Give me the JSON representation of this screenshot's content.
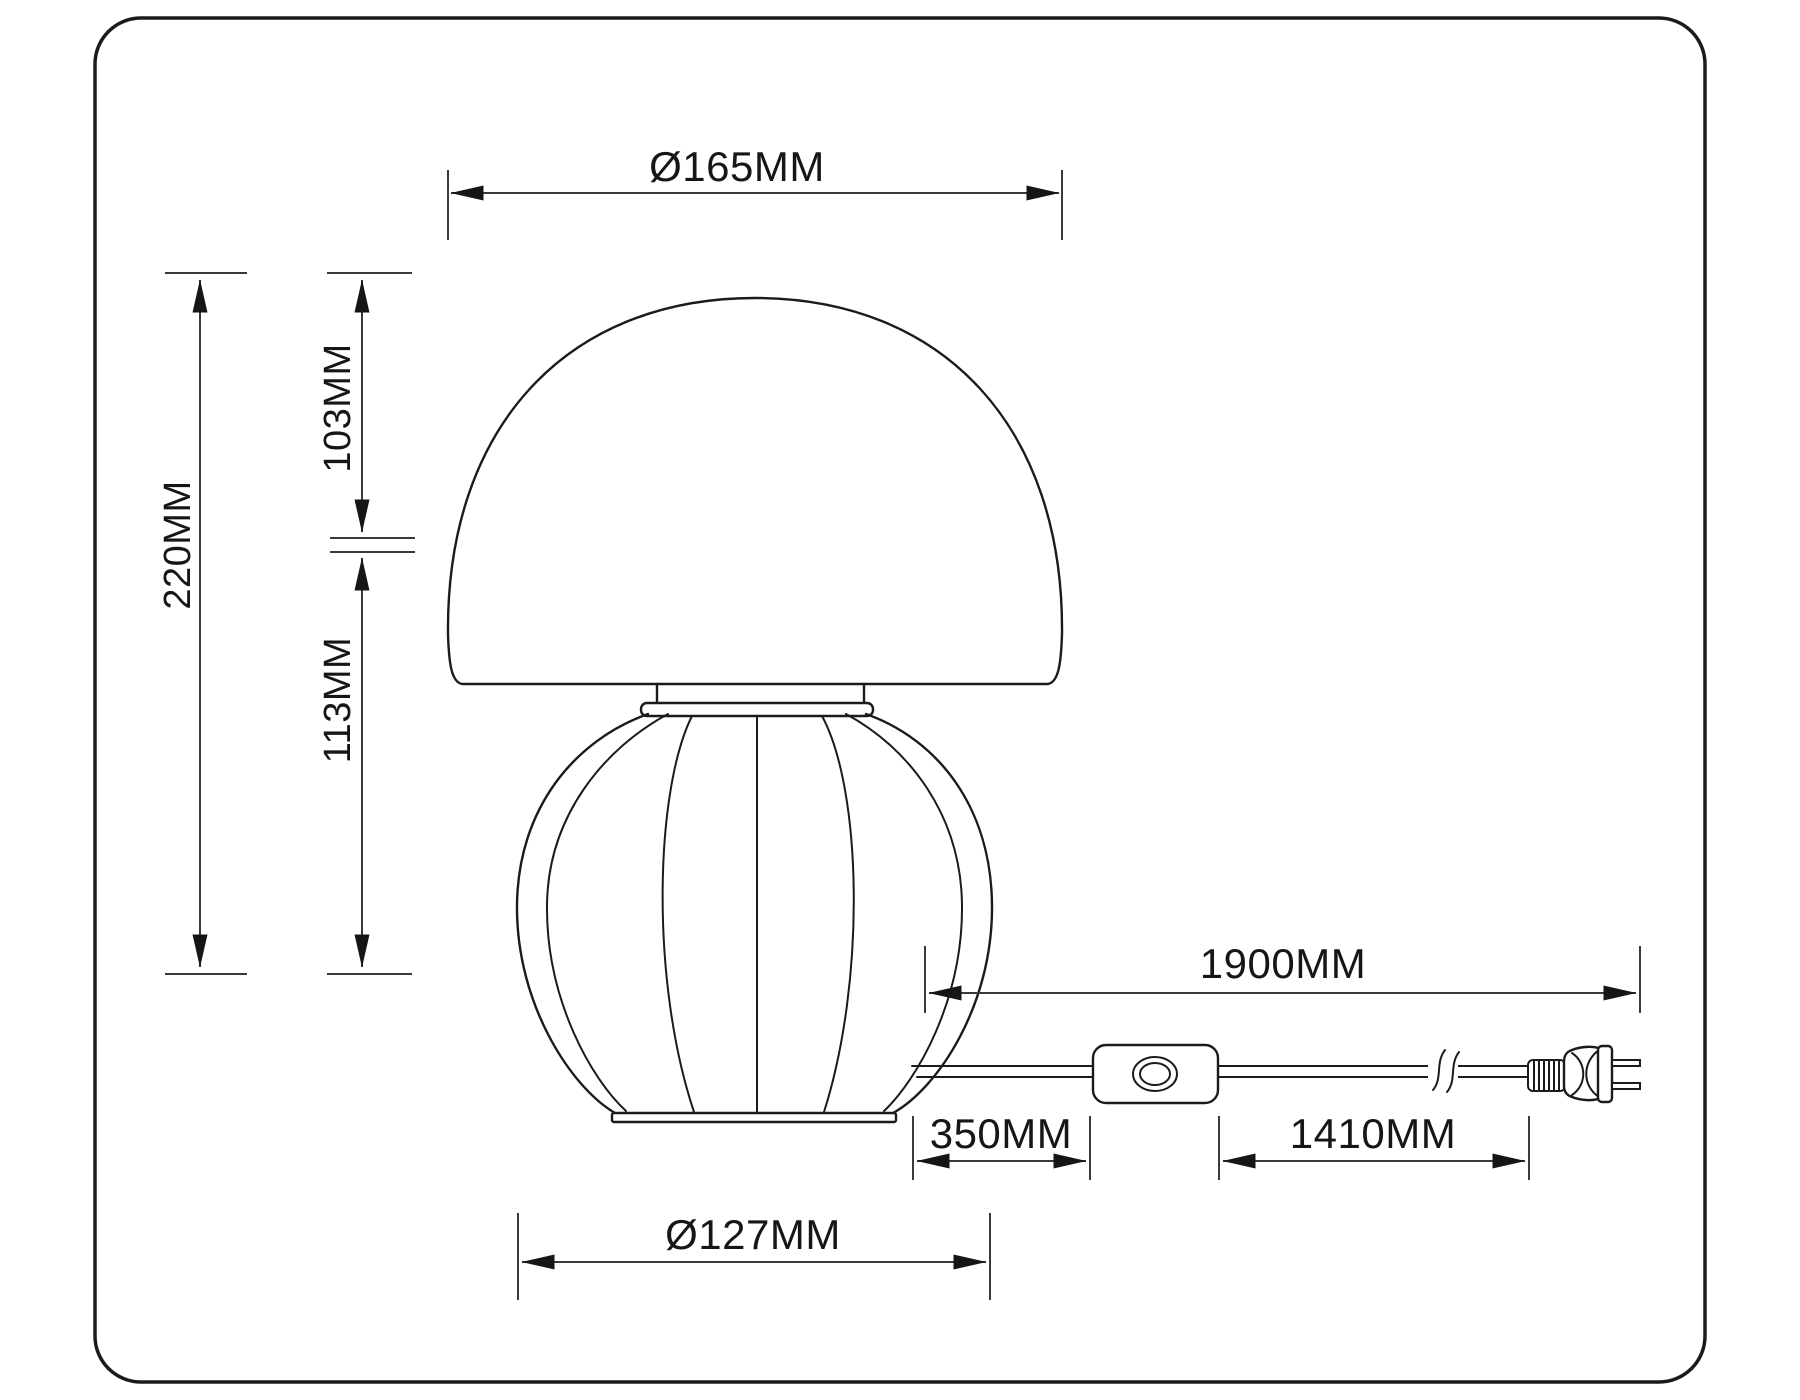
{
  "diagram": {
    "type": "technical-dimension-drawing",
    "subject": "mushroom table lamp with inline cord switch and two-prong plug",
    "line_color": "#1b1b1b",
    "background": "#ffffff",
    "dims": {
      "shade_diameter": "Ø165MM",
      "total_height": "220MM",
      "shade_height": "103MM",
      "body_height": "113MM",
      "cord_total_length": "1900MM",
      "base_to_switch": "350MM",
      "switch_to_plug": "1410MM",
      "body_diameter": "Ø127MM"
    }
  }
}
